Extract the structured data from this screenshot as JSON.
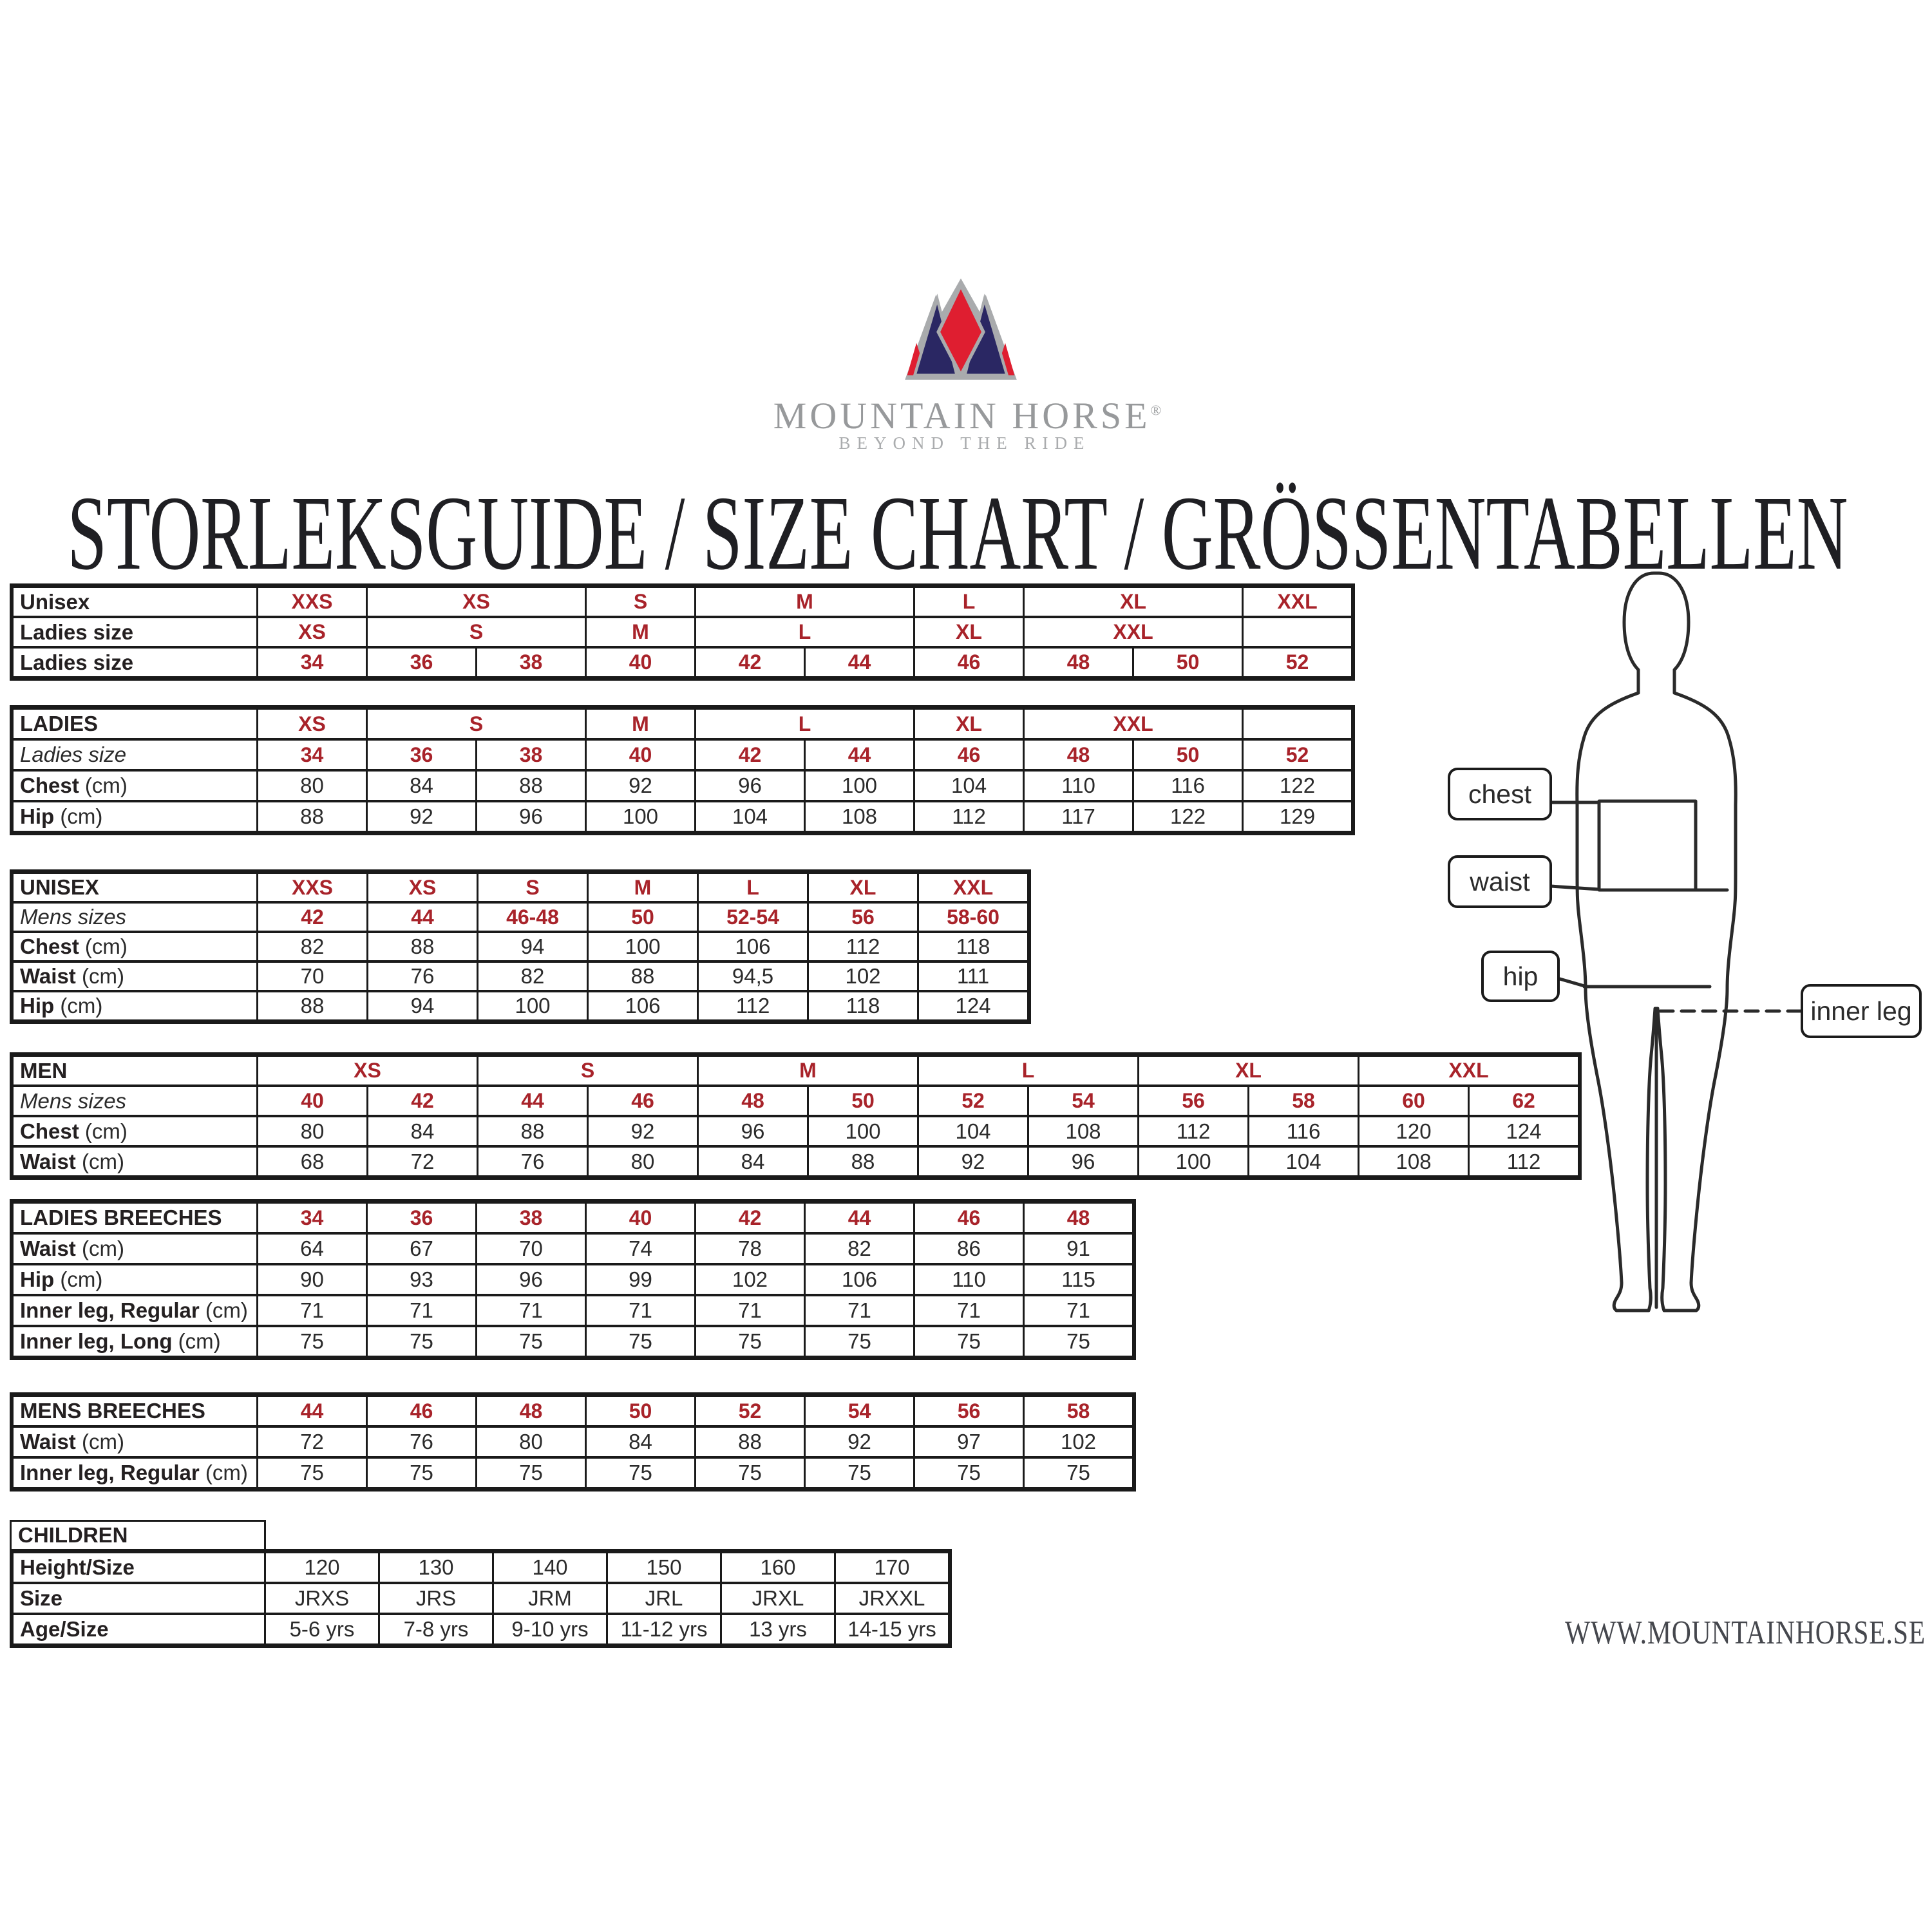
{
  "title": "STORLEKSGUIDE / SIZE CHART / GRÖSSENTABELLEN",
  "website": "WWW.MOUNTAINHORSE.SE",
  "brand": {
    "name": "MOUNTAIN HORSE",
    "reg_mark": "®",
    "tagline": "BEYOND THE RIDE"
  },
  "colors": {
    "accent_red": "#a8232a",
    "text_black": "#242021",
    "border_black": "#1a1a1a",
    "logo_red": "#df1e30",
    "logo_navy": "#2a2763",
    "logo_gray": "#a9abad",
    "brand_gray": "#97999b",
    "url_gray": "#45474d"
  },
  "figure": {
    "chest": "chest",
    "waist": "waist",
    "hip": "hip",
    "inner_leg": "inner leg"
  },
  "tables": [
    {
      "id": "unisex-ladies-conversion",
      "columns": 10,
      "rows": [
        {
          "label": "Unisex",
          "cell_class": "red",
          "cells": [
            {
              "t": "XXS",
              "s": 1
            },
            {
              "t": "XS",
              "s": 2
            },
            {
              "t": "S",
              "s": 1
            },
            {
              "t": "M",
              "s": 2
            },
            {
              "t": "L",
              "s": 1
            },
            {
              "t": "XL",
              "s": 2
            },
            {
              "t": "XXL",
              "s": 1
            }
          ]
        },
        {
          "label": "Ladies size",
          "cell_class": "red",
          "cells": [
            {
              "t": "XS",
              "s": 1
            },
            {
              "t": "S",
              "s": 2
            },
            {
              "t": "M",
              "s": 1
            },
            {
              "t": "L",
              "s": 2
            },
            {
              "t": "XL",
              "s": 1
            },
            {
              "t": "XXL",
              "s": 2
            },
            {
              "t": "",
              "s": 1
            }
          ]
        },
        {
          "label": "Ladies size",
          "cell_class": "red",
          "cells": [
            {
              "t": "34"
            },
            {
              "t": "36"
            },
            {
              "t": "38"
            },
            {
              "t": "40"
            },
            {
              "t": "42"
            },
            {
              "t": "44"
            },
            {
              "t": "46"
            },
            {
              "t": "48"
            },
            {
              "t": "50"
            },
            {
              "t": "52"
            }
          ]
        }
      ]
    },
    {
      "id": "ladies",
      "columns": 10,
      "rows": [
        {
          "label": "LADIES",
          "cell_class": "red",
          "cells": [
            {
              "t": "XS",
              "s": 1
            },
            {
              "t": "S",
              "s": 2
            },
            {
              "t": "M",
              "s": 1
            },
            {
              "t": "L",
              "s": 2
            },
            {
              "t": "XL",
              "s": 1
            },
            {
              "t": "XXL",
              "s": 2
            },
            {
              "t": "",
              "s": 1
            }
          ]
        },
        {
          "label": "Ladies size",
          "label_class": "italic",
          "cell_class": "red",
          "cells": [
            {
              "t": "34"
            },
            {
              "t": "36"
            },
            {
              "t": "38"
            },
            {
              "t": "40"
            },
            {
              "t": "42"
            },
            {
              "t": "44"
            },
            {
              "t": "46"
            },
            {
              "t": "48"
            },
            {
              "t": "50"
            },
            {
              "t": "52"
            }
          ]
        },
        {
          "label": "Chest",
          "suffix": " (cm)",
          "cells": [
            {
              "t": "80"
            },
            {
              "t": "84"
            },
            {
              "t": "88"
            },
            {
              "t": "92"
            },
            {
              "t": "96"
            },
            {
              "t": "100"
            },
            {
              "t": "104"
            },
            {
              "t": "110"
            },
            {
              "t": "116"
            },
            {
              "t": "122"
            }
          ]
        },
        {
          "label": "Hip",
          "suffix": " (cm)",
          "cells": [
            {
              "t": "88"
            },
            {
              "t": "92"
            },
            {
              "t": "96"
            },
            {
              "t": "100"
            },
            {
              "t": "104"
            },
            {
              "t": "108"
            },
            {
              "t": "112"
            },
            {
              "t": "117"
            },
            {
              "t": "122"
            },
            {
              "t": "129"
            }
          ]
        }
      ]
    },
    {
      "id": "unisex",
      "columns": 7,
      "rows": [
        {
          "label": "UNISEX",
          "cell_class": "red",
          "cells": [
            {
              "t": "XXS"
            },
            {
              "t": "XS"
            },
            {
              "t": "S"
            },
            {
              "t": "M"
            },
            {
              "t": "L"
            },
            {
              "t": "XL"
            },
            {
              "t": "XXL"
            }
          ]
        },
        {
          "label": "Mens sizes",
          "label_class": "italic",
          "cell_class": "red",
          "cells": [
            {
              "t": "42"
            },
            {
              "t": "44"
            },
            {
              "t": "46-48"
            },
            {
              "t": "50"
            },
            {
              "t": "52-54"
            },
            {
              "t": "56"
            },
            {
              "t": "58-60"
            }
          ]
        },
        {
          "label": "Chest",
          "suffix": " (cm)",
          "cells": [
            {
              "t": "82"
            },
            {
              "t": "88"
            },
            {
              "t": "94"
            },
            {
              "t": "100"
            },
            {
              "t": "106"
            },
            {
              "t": "112"
            },
            {
              "t": "118"
            }
          ]
        },
        {
          "label": "Waist",
          "suffix": " (cm)",
          "cells": [
            {
              "t": "70"
            },
            {
              "t": "76"
            },
            {
              "t": "82"
            },
            {
              "t": "88"
            },
            {
              "t": "94,5"
            },
            {
              "t": "102"
            },
            {
              "t": "111"
            }
          ]
        },
        {
          "label": "Hip",
          "suffix": " (cm)",
          "cells": [
            {
              "t": "88"
            },
            {
              "t": "94"
            },
            {
              "t": "100"
            },
            {
              "t": "106"
            },
            {
              "t": "112"
            },
            {
              "t": "118"
            },
            {
              "t": "124"
            }
          ]
        }
      ]
    },
    {
      "id": "men",
      "columns": 12,
      "rows": [
        {
          "label": "MEN",
          "cell_class": "red",
          "cells": [
            {
              "t": "XS",
              "s": 2
            },
            {
              "t": "S",
              "s": 2
            },
            {
              "t": "M",
              "s": 2
            },
            {
              "t": "L",
              "s": 2
            },
            {
              "t": "XL",
              "s": 2
            },
            {
              "t": "XXL",
              "s": 2
            }
          ]
        },
        {
          "label": "Mens sizes",
          "label_class": "italic",
          "cell_class": "red",
          "cells": [
            {
              "t": "40"
            },
            {
              "t": "42"
            },
            {
              "t": "44"
            },
            {
              "t": "46"
            },
            {
              "t": "48"
            },
            {
              "t": "50"
            },
            {
              "t": "52"
            },
            {
              "t": "54"
            },
            {
              "t": "56"
            },
            {
              "t": "58"
            },
            {
              "t": "60"
            },
            {
              "t": "62"
            }
          ]
        },
        {
          "label": "Chest",
          "suffix": " (cm)",
          "cells": [
            {
              "t": "80"
            },
            {
              "t": "84"
            },
            {
              "t": "88"
            },
            {
              "t": "92"
            },
            {
              "t": "96"
            },
            {
              "t": "100"
            },
            {
              "t": "104"
            },
            {
              "t": "108"
            },
            {
              "t": "112"
            },
            {
              "t": "116"
            },
            {
              "t": "120"
            },
            {
              "t": "124"
            }
          ]
        },
        {
          "label": "Waist",
          "suffix": " (cm)",
          "cells": [
            {
              "t": "68"
            },
            {
              "t": "72"
            },
            {
              "t": "76"
            },
            {
              "t": "80"
            },
            {
              "t": "84"
            },
            {
              "t": "88"
            },
            {
              "t": "92"
            },
            {
              "t": "96"
            },
            {
              "t": "100"
            },
            {
              "t": "104"
            },
            {
              "t": "108"
            },
            {
              "t": "112"
            }
          ]
        }
      ]
    },
    {
      "id": "ladies-breeches",
      "columns": 8,
      "rows": [
        {
          "label": "LADIES BREECHES",
          "cell_class": "red",
          "cells": [
            {
              "t": "34"
            },
            {
              "t": "36"
            },
            {
              "t": "38"
            },
            {
              "t": "40"
            },
            {
              "t": "42"
            },
            {
              "t": "44"
            },
            {
              "t": "46"
            },
            {
              "t": "48"
            }
          ]
        },
        {
          "label": "Waist",
          "suffix": " (cm)",
          "cells": [
            {
              "t": "64"
            },
            {
              "t": "67"
            },
            {
              "t": "70"
            },
            {
              "t": "74"
            },
            {
              "t": "78"
            },
            {
              "t": "82"
            },
            {
              "t": "86"
            },
            {
              "t": "91"
            }
          ]
        },
        {
          "label": "Hip",
          "suffix": " (cm)",
          "cells": [
            {
              "t": "90"
            },
            {
              "t": "93"
            },
            {
              "t": "96"
            },
            {
              "t": "99"
            },
            {
              "t": "102"
            },
            {
              "t": "106"
            },
            {
              "t": "110"
            },
            {
              "t": "115"
            }
          ]
        },
        {
          "label": "Inner leg, Regular",
          "suffix": " (cm)",
          "cells": [
            {
              "t": "71"
            },
            {
              "t": "71"
            },
            {
              "t": "71"
            },
            {
              "t": "71"
            },
            {
              "t": "71"
            },
            {
              "t": "71"
            },
            {
              "t": "71"
            },
            {
              "t": "71"
            }
          ]
        },
        {
          "label": "Inner leg, Long",
          "suffix": " (cm)",
          "cells": [
            {
              "t": "75"
            },
            {
              "t": "75"
            },
            {
              "t": "75"
            },
            {
              "t": "75"
            },
            {
              "t": "75"
            },
            {
              "t": "75"
            },
            {
              "t": "75"
            },
            {
              "t": "75"
            }
          ]
        }
      ]
    },
    {
      "id": "mens-breeches",
      "columns": 8,
      "rows": [
        {
          "label": "MENS BREECHES",
          "cell_class": "red",
          "cells": [
            {
              "t": "44"
            },
            {
              "t": "46"
            },
            {
              "t": "48"
            },
            {
              "t": "50"
            },
            {
              "t": "52"
            },
            {
              "t": "54"
            },
            {
              "t": "56"
            },
            {
              "t": "58"
            }
          ]
        },
        {
          "label": "Waist",
          "suffix": " (cm)",
          "cells": [
            {
              "t": "72"
            },
            {
              "t": "76"
            },
            {
              "t": "80"
            },
            {
              "t": "84"
            },
            {
              "t": "88"
            },
            {
              "t": "92"
            },
            {
              "t": "97"
            },
            {
              "t": "102"
            }
          ]
        },
        {
          "label": "Inner leg, Regular",
          "suffix": " (cm)",
          "cells": [
            {
              "t": "75"
            },
            {
              "t": "75"
            },
            {
              "t": "75"
            },
            {
              "t": "75"
            },
            {
              "t": "75"
            },
            {
              "t": "75"
            },
            {
              "t": "75"
            },
            {
              "t": "75"
            }
          ]
        }
      ]
    },
    {
      "id": "children",
      "header": "CHILDREN",
      "columns": 6,
      "rows": [
        {
          "label": "Height/Size",
          "cells": [
            {
              "t": "120"
            },
            {
              "t": "130"
            },
            {
              "t": "140"
            },
            {
              "t": "150"
            },
            {
              "t": "160"
            },
            {
              "t": "170"
            }
          ]
        },
        {
          "label": "Size",
          "cells": [
            {
              "t": "JRXS"
            },
            {
              "t": "JRS"
            },
            {
              "t": "JRM"
            },
            {
              "t": "JRL"
            },
            {
              "t": "JRXL"
            },
            {
              "t": "JRXXL"
            }
          ]
        },
        {
          "label": "Age/Size",
          "cells": [
            {
              "t": "5-6 yrs"
            },
            {
              "t": "7-8 yrs"
            },
            {
              "t": "9-10 yrs"
            },
            {
              "t": "11-12 yrs"
            },
            {
              "t": "13 yrs"
            },
            {
              "t": "14-15 yrs"
            }
          ]
        }
      ]
    }
  ]
}
